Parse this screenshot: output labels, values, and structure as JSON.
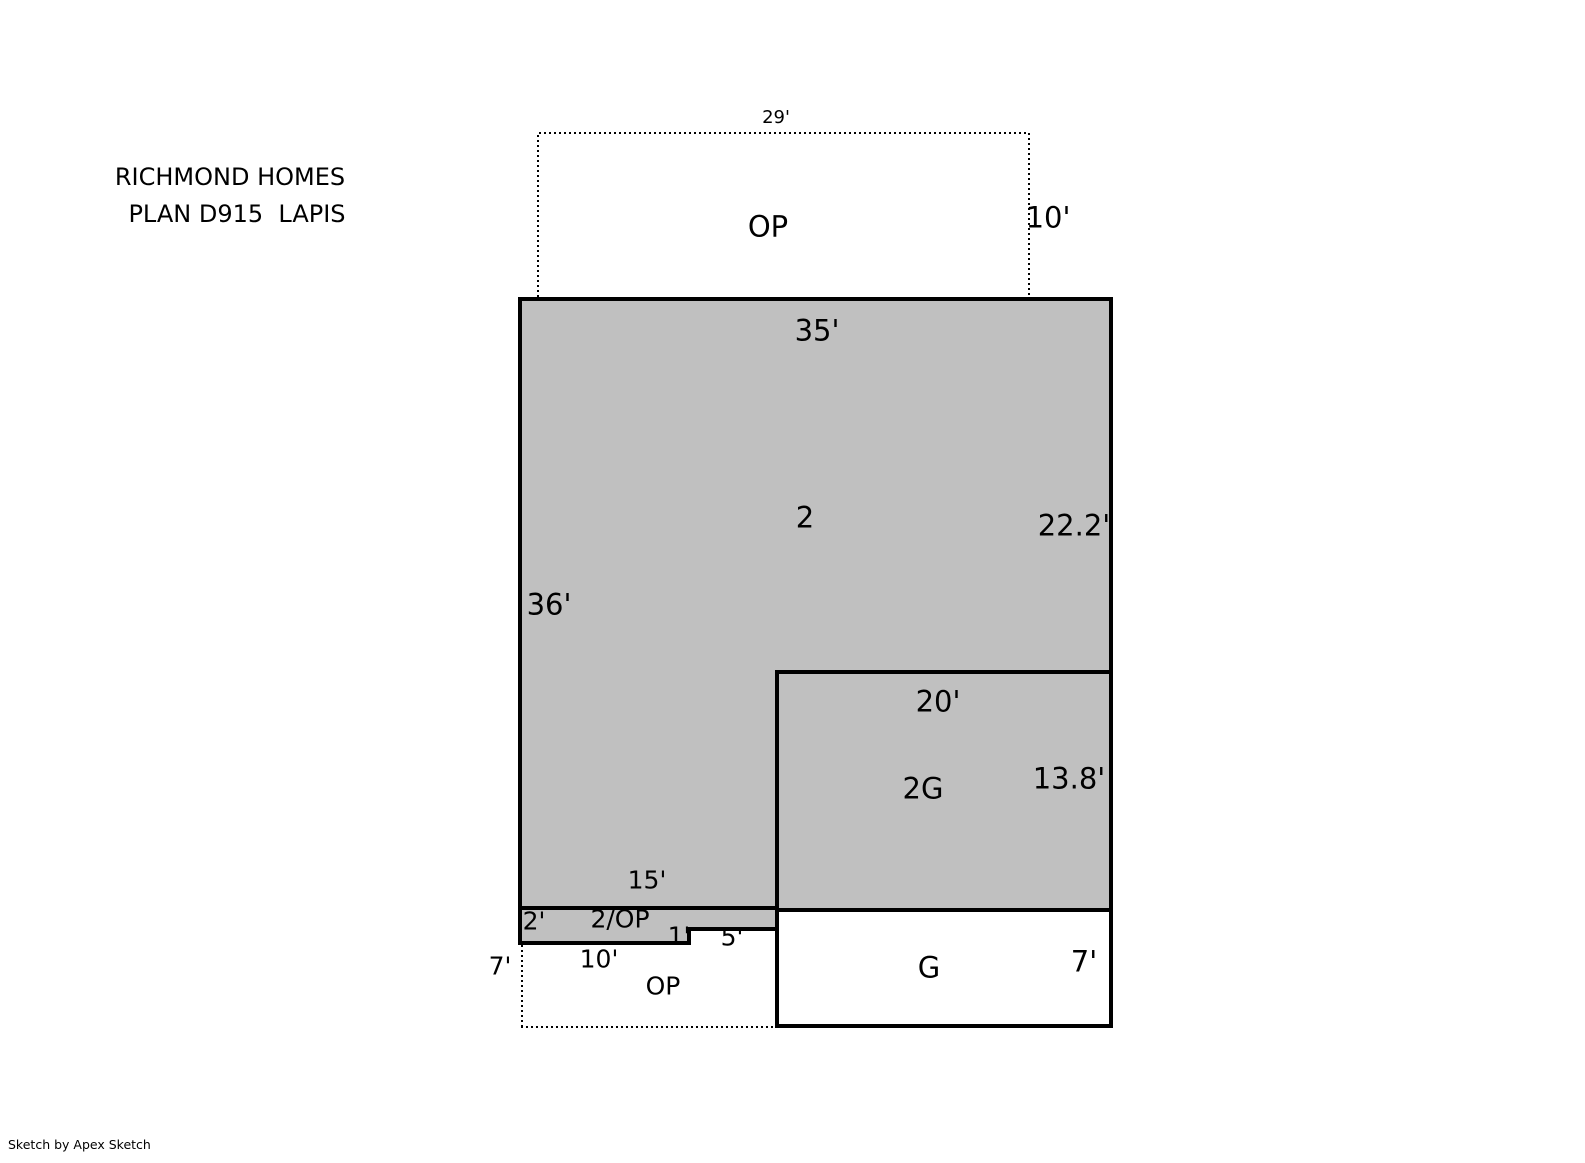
{
  "title": {
    "line1": "RICHMOND HOMES",
    "line2": "PLAN D915  LAPIS"
  },
  "plan": {
    "upper_porch": {
      "label": "OP",
      "width": "29'",
      "depth": "10'"
    },
    "second_floor": {
      "label": "2",
      "top": "35'",
      "right": "22.2'",
      "left": "36'",
      "bottom_segment": "15'"
    },
    "garage_second": {
      "label": "2G",
      "top": "20'",
      "right": "13.8'"
    },
    "overhang_strip": {
      "label": "2/OP",
      "left": "2'",
      "bottom": "10'",
      "step": "1'",
      "segment": "5'"
    },
    "lower_porch": {
      "label": "OP",
      "left": "7'"
    },
    "garage": {
      "label": "G",
      "right": "7'"
    }
  },
  "colors": {
    "area_fill": "#C0C0C0",
    "line": "#000000",
    "background": "#FFFFFF"
  },
  "footer": {
    "credit": "Sketch by Apex Sketch"
  }
}
